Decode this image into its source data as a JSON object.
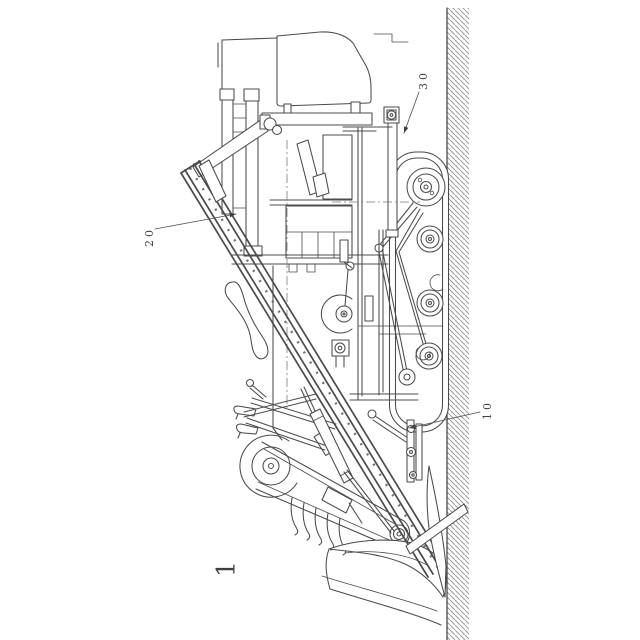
{
  "figure": {
    "number": "1",
    "labels": [
      {
        "text": "30"
      },
      {
        "text": "20"
      },
      {
        "text": "10"
      }
    ]
  },
  "colors": {
    "paper": "#ffffff",
    "line": "#4b4b4b",
    "hatch": "#9b9b9b",
    "ink": "#3f3f3f"
  }
}
